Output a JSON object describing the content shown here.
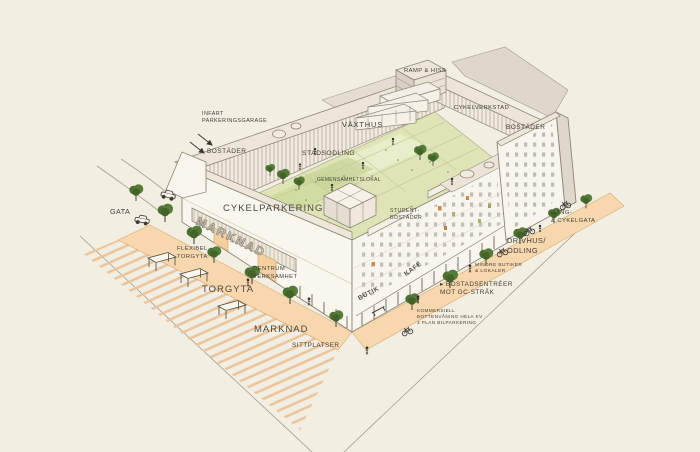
{
  "labels": {
    "infart": "INFART\nPARKERINGSGARAGE",
    "bostader_nw": "BOSTÄDER",
    "ramp_hiss": "RAMP & HISS",
    "cykelverkstad": "CYKELVERKSTAD",
    "bostader_ne": "BOSTÄDER",
    "vaxthus": "VÄXTHUS",
    "stadsodling": "STADSODLING",
    "gemensamhetslokal": "GEMENSAMHETSLOKAL",
    "gata": "GATA",
    "cykelparkering": "CYKELPARKERING",
    "studentbostader": "STUDENT-\nBOSTÄDER",
    "gang_cykelgata": "GÅNG-\n& CYKELGATA",
    "flexibel_torgyta": "FLEXIBEL\nTORGYTA",
    "centrum_verksamhet": "CENTRUM\nVERKSAMHET",
    "drivhus_odling": "DRIVHUS/\nODLING",
    "mindre_butiker": "MINDRE BUTIKER\n& LOKALER",
    "torgyta": "TORGYTA",
    "bostadsentreer": "▸ BOSTADSENTRÉER\nMOT GC-STRÅK",
    "kommersiell": "KOMMERSIELL\nBOTTENVÅNING HELA KV\n3 PLAN BILPARKERING",
    "marknad_ground": "MARKNAD",
    "sittplatser": "SITTPLATSER",
    "marknad_facade": "MARKNAD",
    "butik_facade": "BUTIK",
    "kafe_facade": "KAFÉ"
  },
  "colors": {
    "paper": "#f3eee2",
    "street_peach": "#f7d7ae",
    "hatch_tan": "#eac49a",
    "courtyard_green": "#dee4b6",
    "bed_green": "#cfdaa0",
    "tree_green": "#4c7032",
    "building_white": "#f8f5ee",
    "roof_cream": "#ebe6d7",
    "shade_gray": "#ddd8ca",
    "line_ink": "#8b8578",
    "text_ink": "#433f37",
    "accent_orange": "#cd8a4e",
    "accent_olive": "#a9b26d"
  }
}
